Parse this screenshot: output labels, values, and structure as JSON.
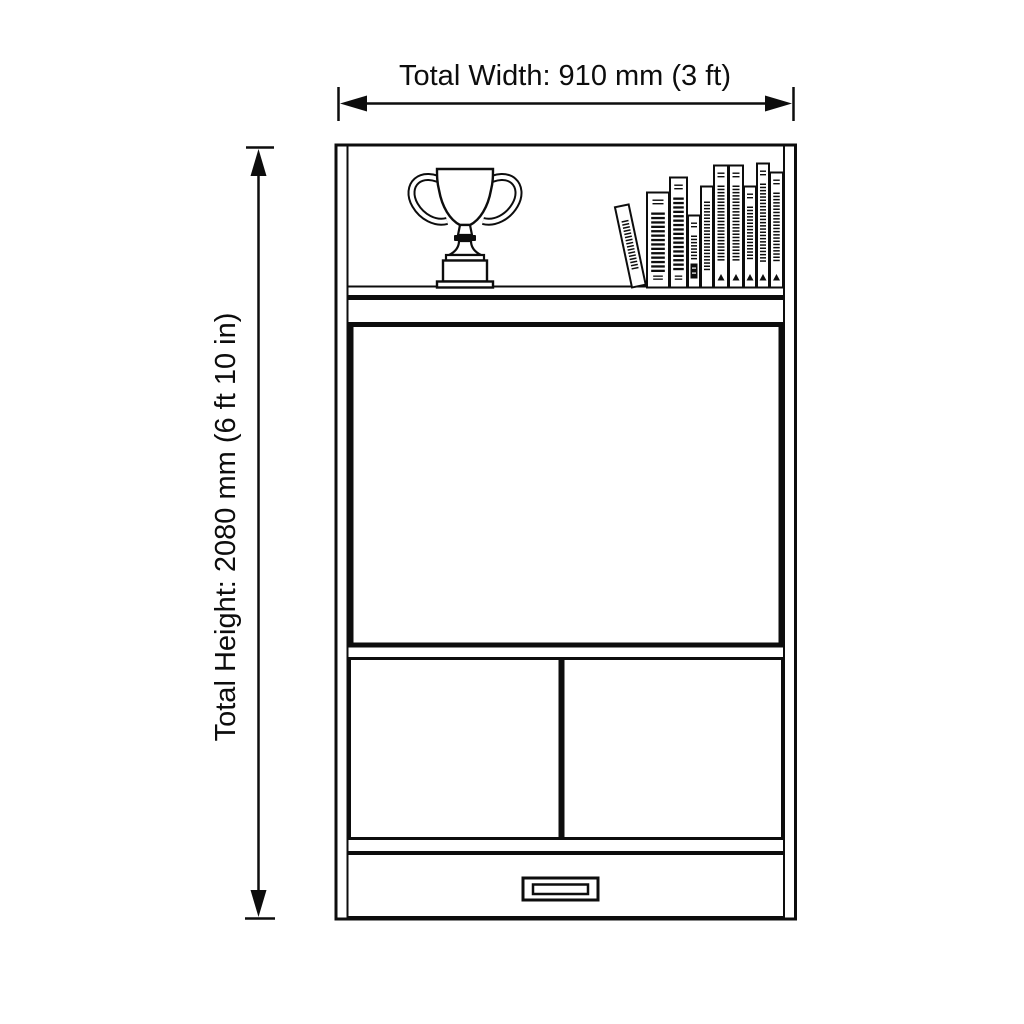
{
  "labels": {
    "total_width": "Total Width: 910 mm (3 ft)",
    "total_height": "Total Height: 2080 mm (6 ft 10 in)"
  },
  "colors": {
    "ink": "#0d0d0d",
    "background": "#ffffff"
  },
  "shelf_contents": {
    "items": [
      "trophy",
      "books"
    ],
    "books": [
      {
        "x": 632,
        "w": 14,
        "h": 82,
        "lean_deg": -12,
        "style": "dense"
      },
      {
        "x": 647,
        "w": 22,
        "h": 95,
        "lean_deg": 0,
        "style": "title"
      },
      {
        "x": 670,
        "w": 17,
        "h": 110,
        "lean_deg": 0,
        "style": "title"
      },
      {
        "x": 688,
        "w": 12,
        "h": 72,
        "lean_deg": 0,
        "style": "barcode"
      },
      {
        "x": 701,
        "w": 12,
        "h": 101,
        "lean_deg": 0,
        "style": "dense"
      },
      {
        "x": 714,
        "w": 14,
        "h": 122,
        "lean_deg": 0,
        "style": "logo"
      },
      {
        "x": 729,
        "w": 14,
        "h": 122,
        "lean_deg": 0,
        "style": "logo"
      },
      {
        "x": 744,
        "w": 12,
        "h": 101,
        "lean_deg": 0,
        "style": "logo"
      },
      {
        "x": 757,
        "w": 12,
        "h": 124,
        "lean_deg": 0,
        "style": "logo"
      },
      {
        "x": 770,
        "w": 13,
        "h": 115,
        "lean_deg": 0,
        "style": "logo"
      }
    ]
  }
}
